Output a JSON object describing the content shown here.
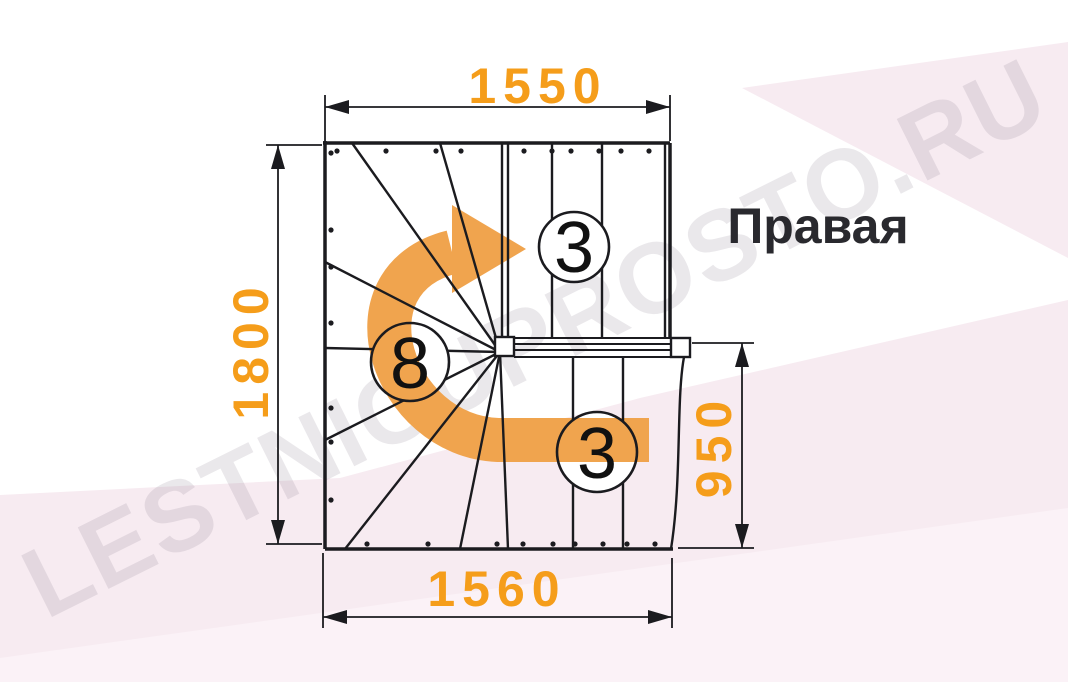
{
  "watermark": {
    "text": "LESTNICUPROSTO.RU"
  },
  "plan": {
    "orientation_label": "Правая",
    "dimensions": {
      "top_width": "1550",
      "left_height": "1800",
      "right_height": "950",
      "bottom_width": "1560"
    },
    "step_badges": {
      "upper_flight": "3",
      "winder": "8",
      "lower_flight": "3"
    }
  },
  "colors": {
    "dimension_orange": "#F59D1A",
    "arrow_orange": "#F0A44E",
    "line_black": "#1b1b1f",
    "title_color": "#29292e",
    "background_pink": "#f7ebf1",
    "background_pink_light": "#fbf2f7"
  }
}
